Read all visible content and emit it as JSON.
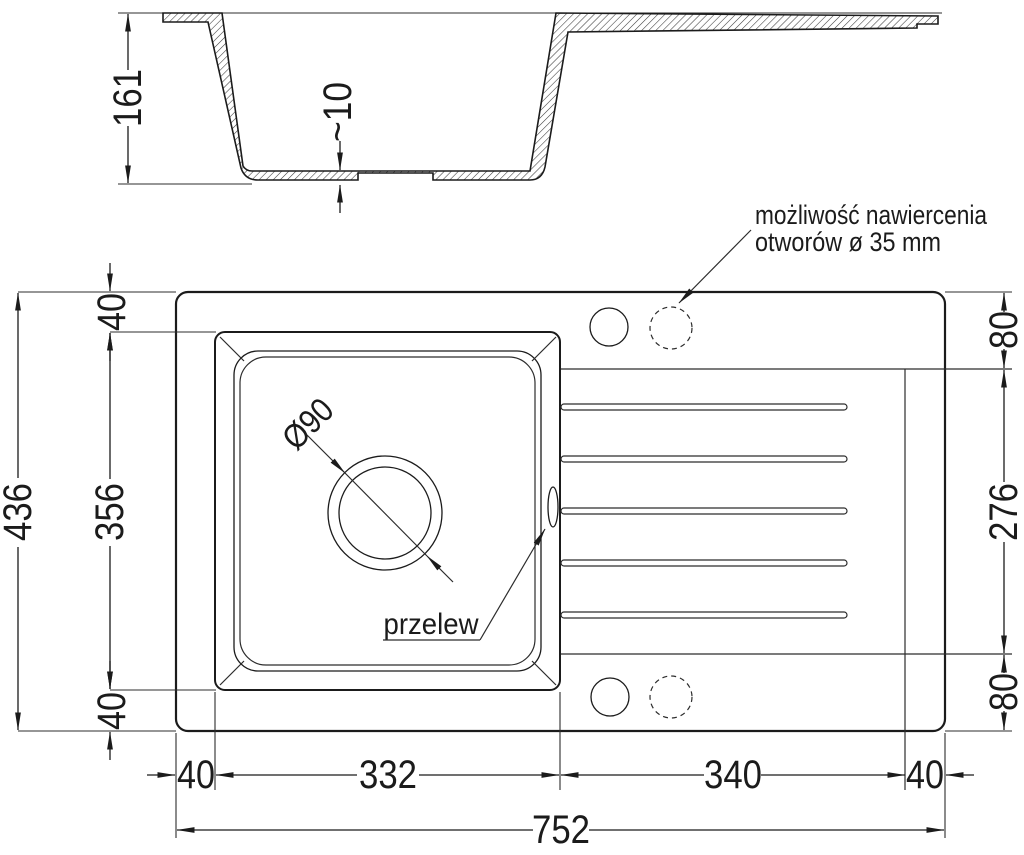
{
  "colors": {
    "line": "#1b1b1b",
    "background": "#ffffff"
  },
  "section": {
    "height": "161",
    "bottom_thickness": "~10"
  },
  "plan": {
    "drill_note_line1": "możliwość nawiercenia",
    "drill_note_line2": "otworów ø 35 mm",
    "overflow_label": "przelew",
    "drain_diameter": "Ø90"
  },
  "dims": {
    "total_depth": "436",
    "bowl_depth": "356",
    "top_margin": "40",
    "bottom_margin": "40",
    "right_top_offset": "80",
    "drainer_depth": "276",
    "right_bottom_offset": "80",
    "left_margin": "40",
    "bowl_width": "332",
    "drainer_width": "340",
    "right_margin": "40",
    "total_width": "752"
  }
}
